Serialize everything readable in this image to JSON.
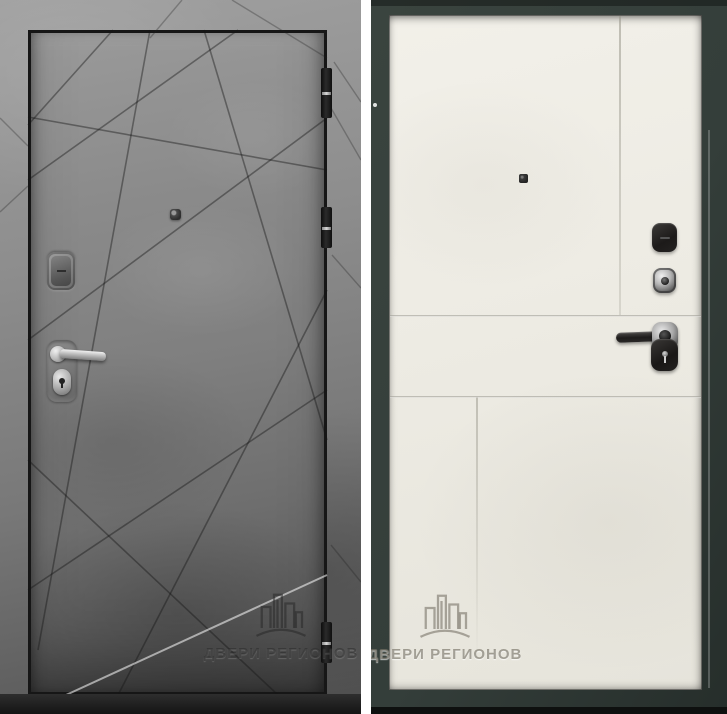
{
  "watermark": {
    "brand": "ДВЕРИ РЕГИОНОВ"
  },
  "panels": {
    "left": {
      "name": "door-front-exterior-gray-concrete"
    },
    "right": {
      "name": "door-back-interior-cream-panel"
    }
  },
  "hardware": {
    "left": [
      "peephole",
      "lock-escutcheon",
      "lever-handle",
      "cylinder-lock",
      "hinge",
      "hinge",
      "hinge"
    ],
    "right": [
      "peephole",
      "thumb-turn-knob",
      "chrome-keyhole-escutcheon",
      "lever-handle",
      "night-lock"
    ]
  },
  "colors": {
    "wall-gray": "#a0a0a0",
    "door-gray-light": "#9a9a9a",
    "door-gray-dark": "#4c4c4c",
    "outline-black": "#161616",
    "frame-green": "#3a443f",
    "frame-green-dark": "#262e2b",
    "panel-cream": "#edebe3",
    "divider-white": "#ffffff"
  }
}
